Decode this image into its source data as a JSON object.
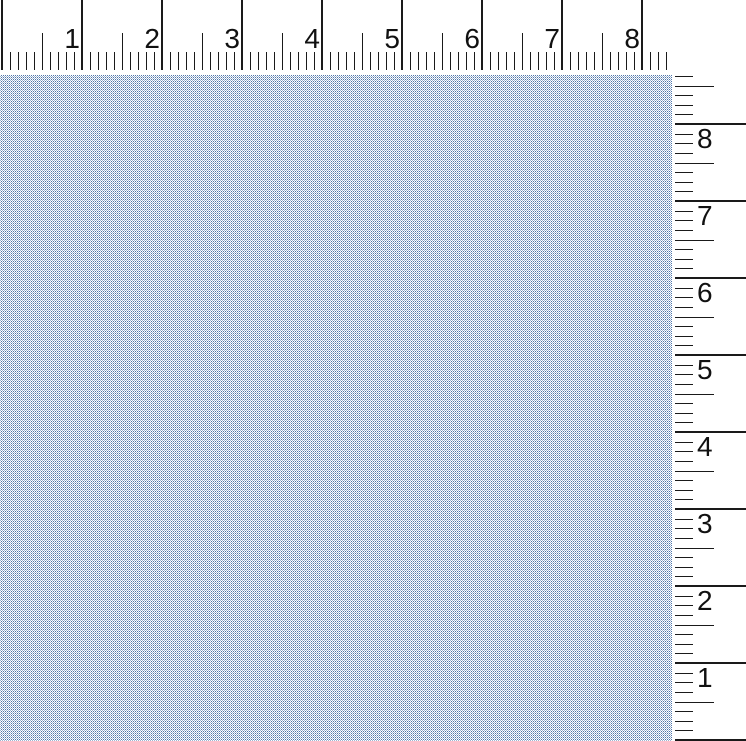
{
  "colors": {
    "ruler_background": "#ffffff",
    "tick_color": "#1a1a1a",
    "number_color": "#111111",
    "desktop_pattern_blue": "#4f77ab",
    "desktop_pattern_base": "#ffffff",
    "desktop_average_tone": "#b0c3da"
  },
  "top_ruler": {
    "unit": "inch",
    "unit_labels": [
      "1",
      "2",
      "3",
      "4",
      "5",
      "6",
      "7",
      "8"
    ],
    "pixels_per_unit": 80,
    "minor_divisions_per_unit": 10,
    "half_unit_ticks": true
  },
  "right_ruler": {
    "unit": "inch",
    "unit_labels": [
      "8",
      "7",
      "6",
      "5",
      "4",
      "3",
      "2",
      "1"
    ],
    "pixels_per_unit": 77,
    "minor_divisions_per_unit": 8,
    "half_unit_ticks": true
  }
}
